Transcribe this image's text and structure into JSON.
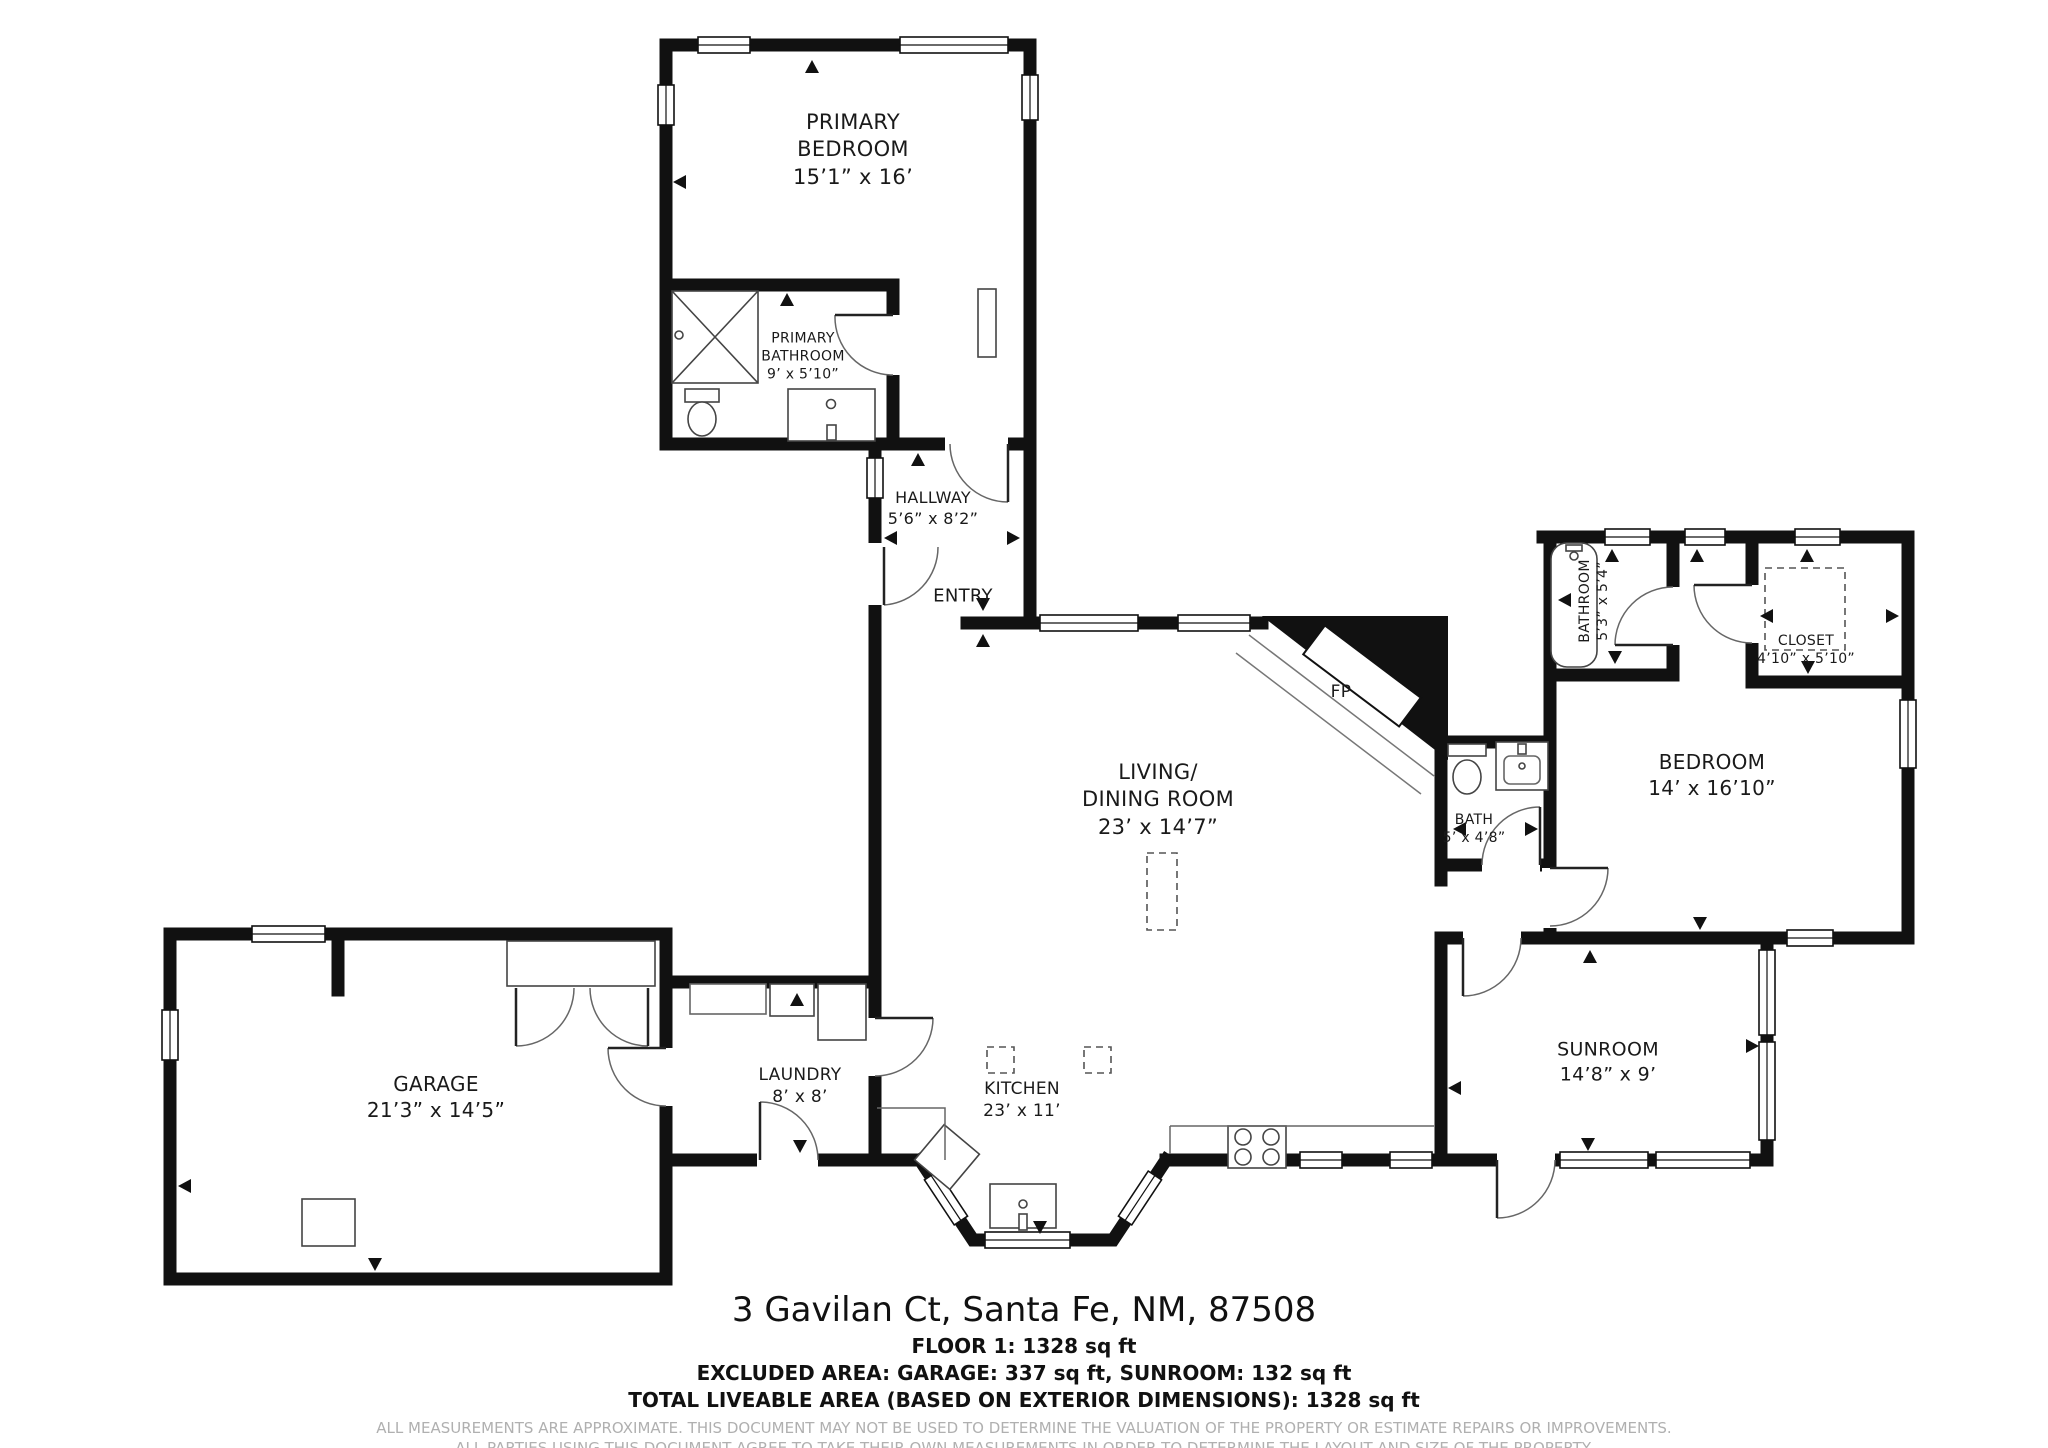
{
  "rooms": [
    {
      "name": "PRIMARY\nBEDROOM",
      "dims": "15’1” x 16’"
    },
    {
      "name": "PRIMARY\nBATHROOM",
      "dims": "9’ x 5’10”"
    },
    {
      "name": "HALLWAY",
      "dims": "5’6” x 8’2”"
    },
    {
      "name": "ENTRY",
      "dims": ""
    },
    {
      "name": "LIVING/\nDINING ROOM",
      "dims": "23’ x 14’7”"
    },
    {
      "name": "BATHROOM",
      "dims": "5’3” x 5’4”"
    },
    {
      "name": "CLOSET",
      "dims": "4’10” x 5’10”"
    },
    {
      "name": "BEDROOM",
      "dims": "14’ x 16’10”"
    },
    {
      "name": "BATH",
      "dims": "5’ x 4’8”"
    },
    {
      "name": "SUNROOM",
      "dims": "14’8” x 9’"
    },
    {
      "name": "GARAGE",
      "dims": "21’3” x 14’5”"
    },
    {
      "name": "LAUNDRY",
      "dims": "8’ x 8’"
    },
    {
      "name": "KITCHEN",
      "dims": "23’ x 11’"
    }
  ],
  "fp_label": "FP",
  "footer": {
    "address": "3 Gavilan Ct, Santa Fe, NM, 87508",
    "floor": "FLOOR 1: 1328 sq ft",
    "excluded": "EXCLUDED AREA: GARAGE: 337 sq ft, SUNROOM: 132 sq ft",
    "total": "TOTAL LIVEABLE AREA (BASED ON EXTERIOR DIMENSIONS): 1328 sq ft",
    "disclaimer1": "ALL MEASUREMENTS ARE APPROXIMATE. THIS DOCUMENT MAY NOT BE USED TO DETERMINE THE VALUATION OF THE PROPERTY OR ESTIMATE REPAIRS OR IMPROVEMENTS.",
    "disclaimer2": "ALL PARTIES USING THIS DOCUMENT AGREE TO TAKE THEIR OWN MEASUREMENTS IN ORDER TO DETERMINE THE LAYOUT AND SIZE OF THE PROPERTY."
  },
  "colors": {
    "wall": "#111111",
    "fixture_line": "#444444",
    "disclaimer_text": "#b0b0b0",
    "background": "#ffffff"
  }
}
